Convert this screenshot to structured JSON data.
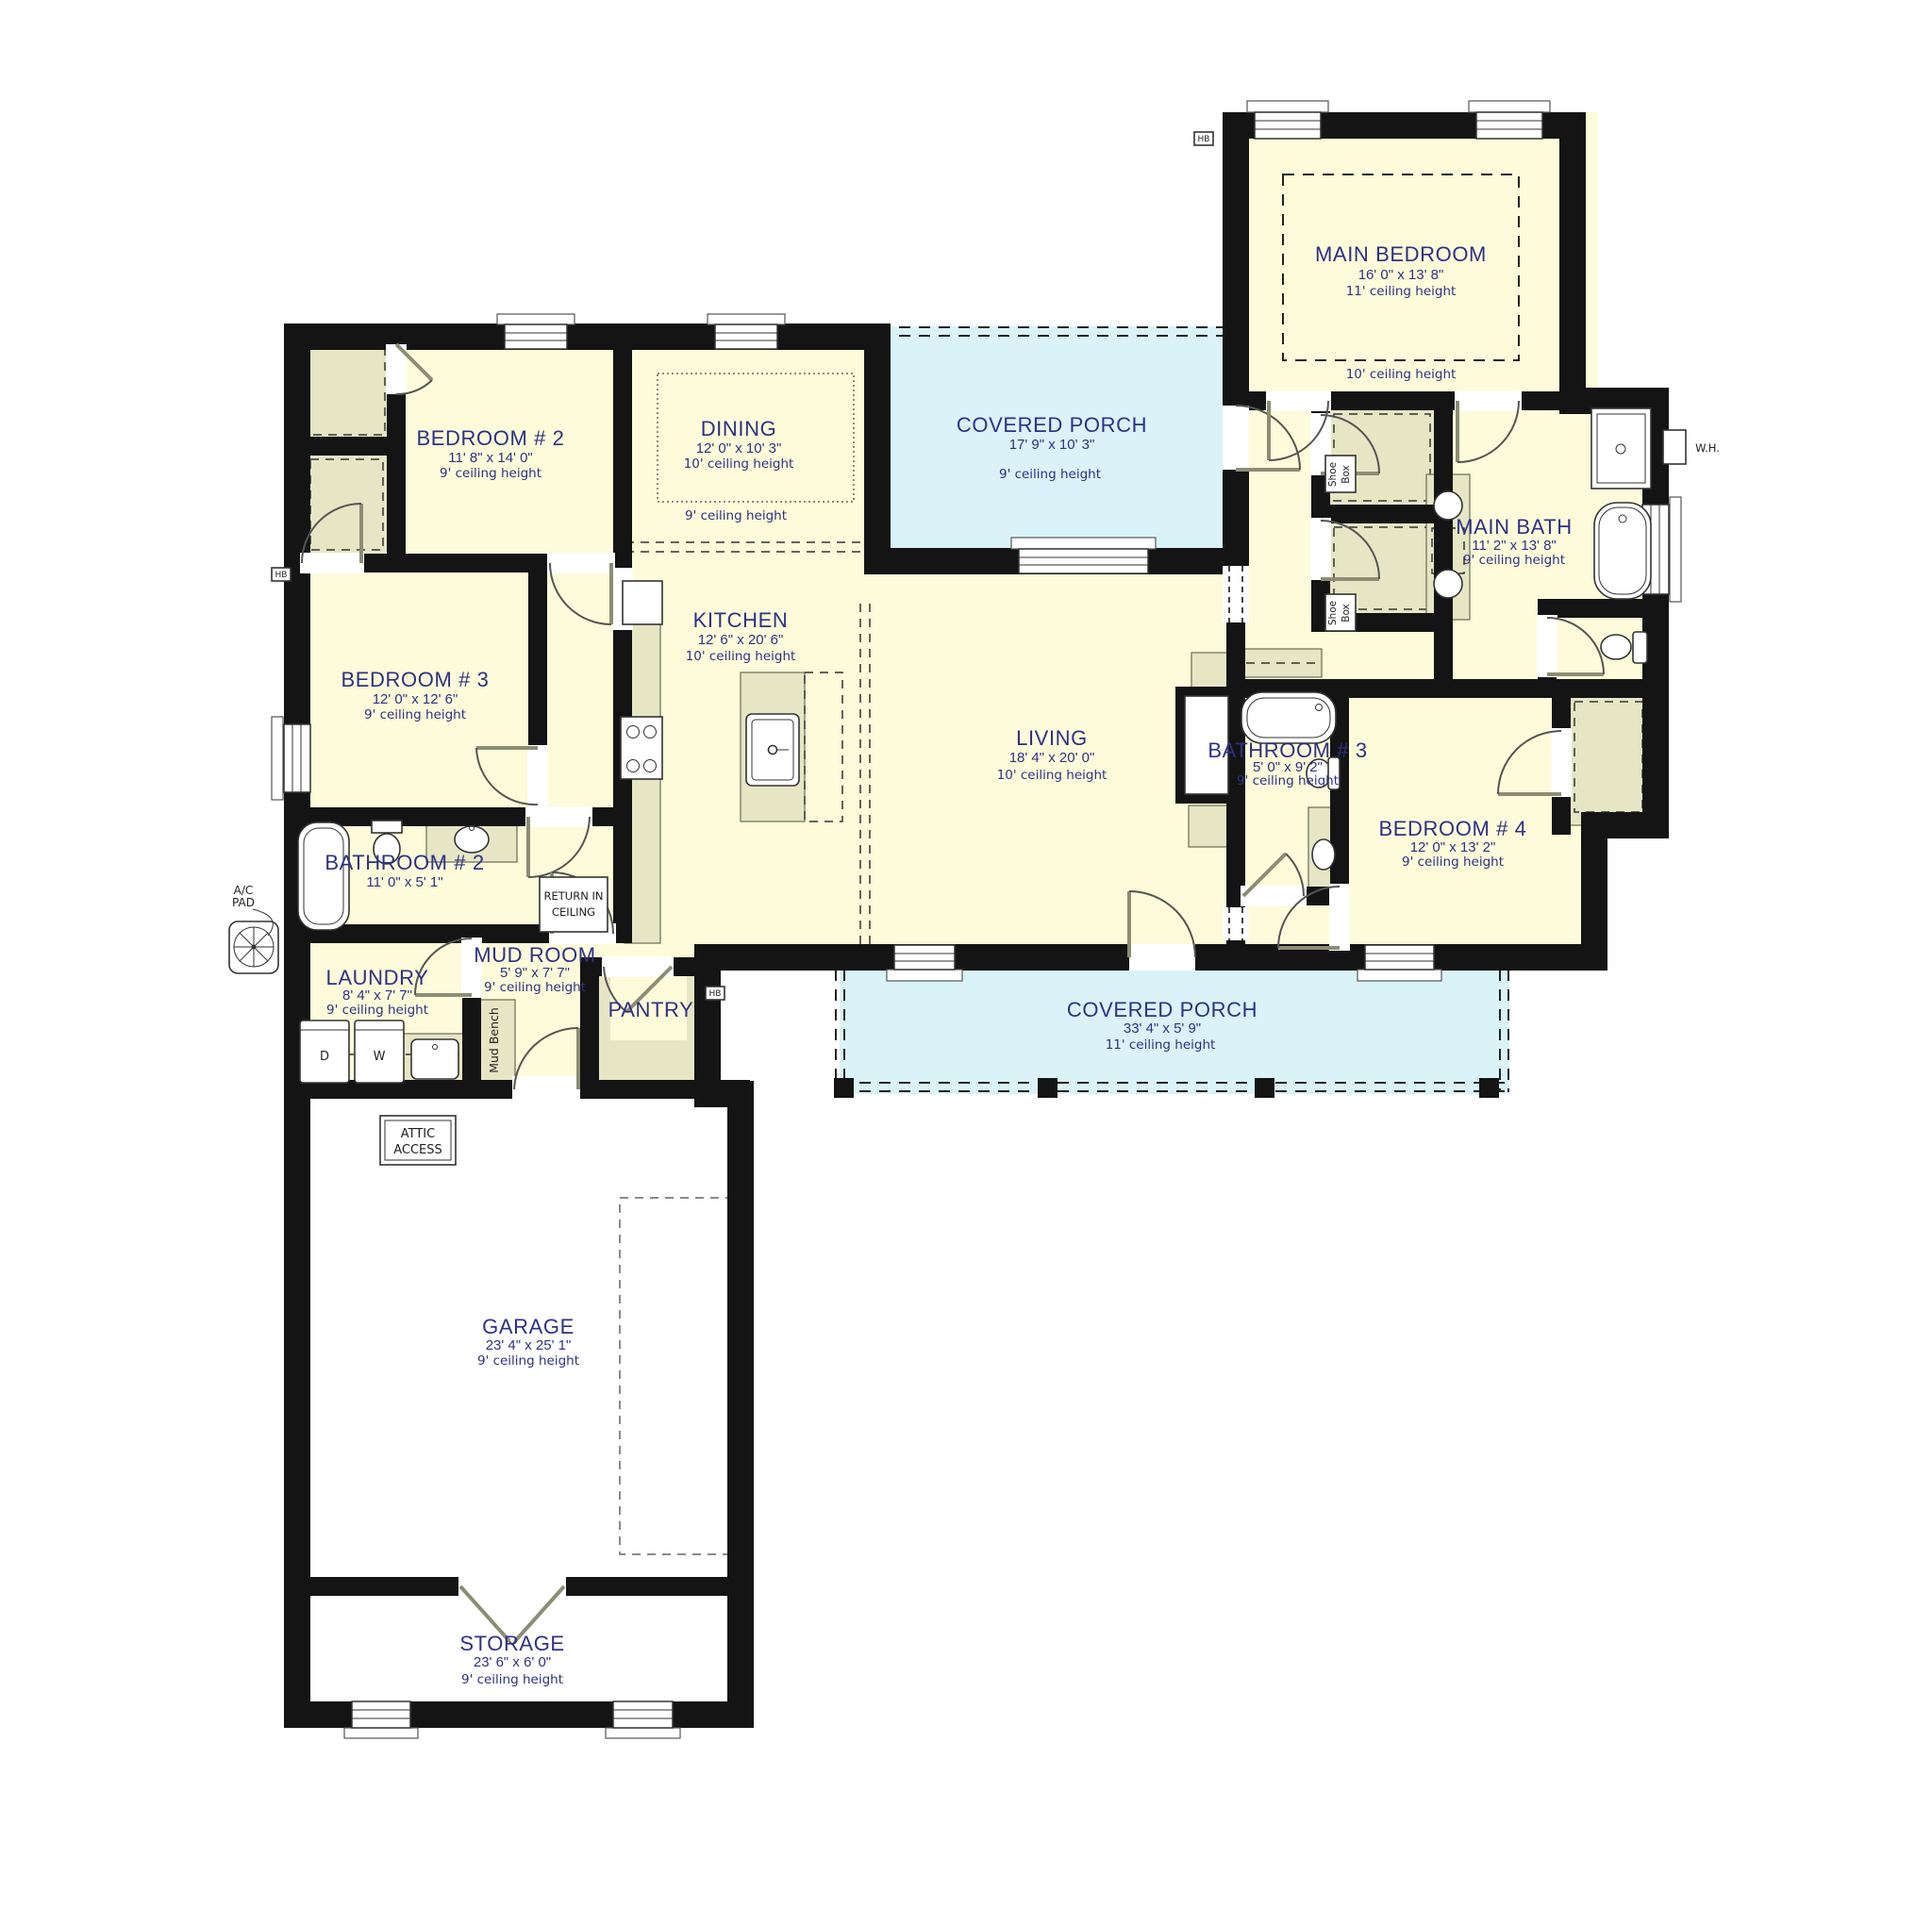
{
  "colors": {
    "room_fill": "#fdfbd9",
    "closet_fill": "#e6e6c5",
    "porch_fill": "#d9f3f8",
    "wall": "#141414",
    "label_text": "#2d3186",
    "annotation_text": "#222222"
  },
  "rooms": {
    "main_bedroom": {
      "name": "MAIN BEDROOM",
      "dims": "16' 0\" x 13' 8\"",
      "ceiling_tray": "11' ceiling height",
      "ceiling_main": "10' ceiling height"
    },
    "bedroom_2": {
      "name": "BEDROOM # 2",
      "dims": "11' 8\" x 14' 0\"",
      "ceiling": "9' ceiling height"
    },
    "bedroom_3": {
      "name": "BEDROOM # 3",
      "dims": "12' 0\" x 12' 6\"",
      "ceiling": "9' ceiling height"
    },
    "bedroom_4": {
      "name": "BEDROOM # 4",
      "dims": "12' 0\" x 13' 2\"",
      "ceiling": "9' ceiling height"
    },
    "dining": {
      "name": "DINING",
      "dims": "12' 0\" x 10' 3\"",
      "ceiling_coffer": "10' ceiling height",
      "ceiling_main": "9' ceiling height"
    },
    "kitchen": {
      "name": "KITCHEN",
      "dims": "12' 6\" x 20' 6\"",
      "ceiling": "10' ceiling height"
    },
    "living": {
      "name": "LIVING",
      "dims": "18' 4\" x 20' 0\"",
      "ceiling": "10' ceiling height"
    },
    "main_bath": {
      "name": "MAIN BATH",
      "dims": "11' 2\" x 13' 8\"",
      "ceiling": "9' ceiling height"
    },
    "bathroom_2": {
      "name": "BATHROOM # 2",
      "dims": "11' 0\" x 5' 1\""
    },
    "bathroom_3": {
      "name": "BATHROOM # 3",
      "dims": "5' 0\" x 9' 2\"",
      "ceiling": "9' ceiling height"
    },
    "laundry": {
      "name": "LAUNDRY",
      "dims": "8' 4\" x 7' 7\"",
      "ceiling": "9' ceiling height"
    },
    "mud_room": {
      "name": "MUD ROOM",
      "dims": "5' 9\" x 7' 7\"",
      "ceiling": "9' ceiling height"
    },
    "pantry": {
      "name": "PANTRY"
    },
    "covered_porch_rear": {
      "name": "COVERED PORCH",
      "dims": "17' 9\" x 10' 3\"",
      "ceiling": "9' ceiling height"
    },
    "covered_porch_front": {
      "name": "COVERED PORCH",
      "dims": "33' 4\" x 5' 9\"",
      "ceiling": "11' ceiling height"
    },
    "garage": {
      "name": "GARAGE",
      "dims": "23' 4\" x 25' 1\"",
      "ceiling": "9' ceiling height"
    },
    "storage": {
      "name": "STORAGE",
      "dims": "23' 6\" x 6' 0\"",
      "ceiling": "9' ceiling height"
    }
  },
  "annotations": {
    "attic_access": {
      "line1": "ATTIC",
      "line2": "ACCESS"
    },
    "return_air": {
      "line1": "RETURN IN",
      "line2": "CEILING"
    },
    "ac_pad": {
      "line1": "A/C",
      "line2": "PAD"
    },
    "shoe_box": {
      "line1": "Shoe",
      "line2": "Box"
    },
    "mud_bench": "Mud Bench",
    "water_heater": "W.H.",
    "dryer": "D",
    "washer": "W",
    "hose_bib": "HB"
  }
}
